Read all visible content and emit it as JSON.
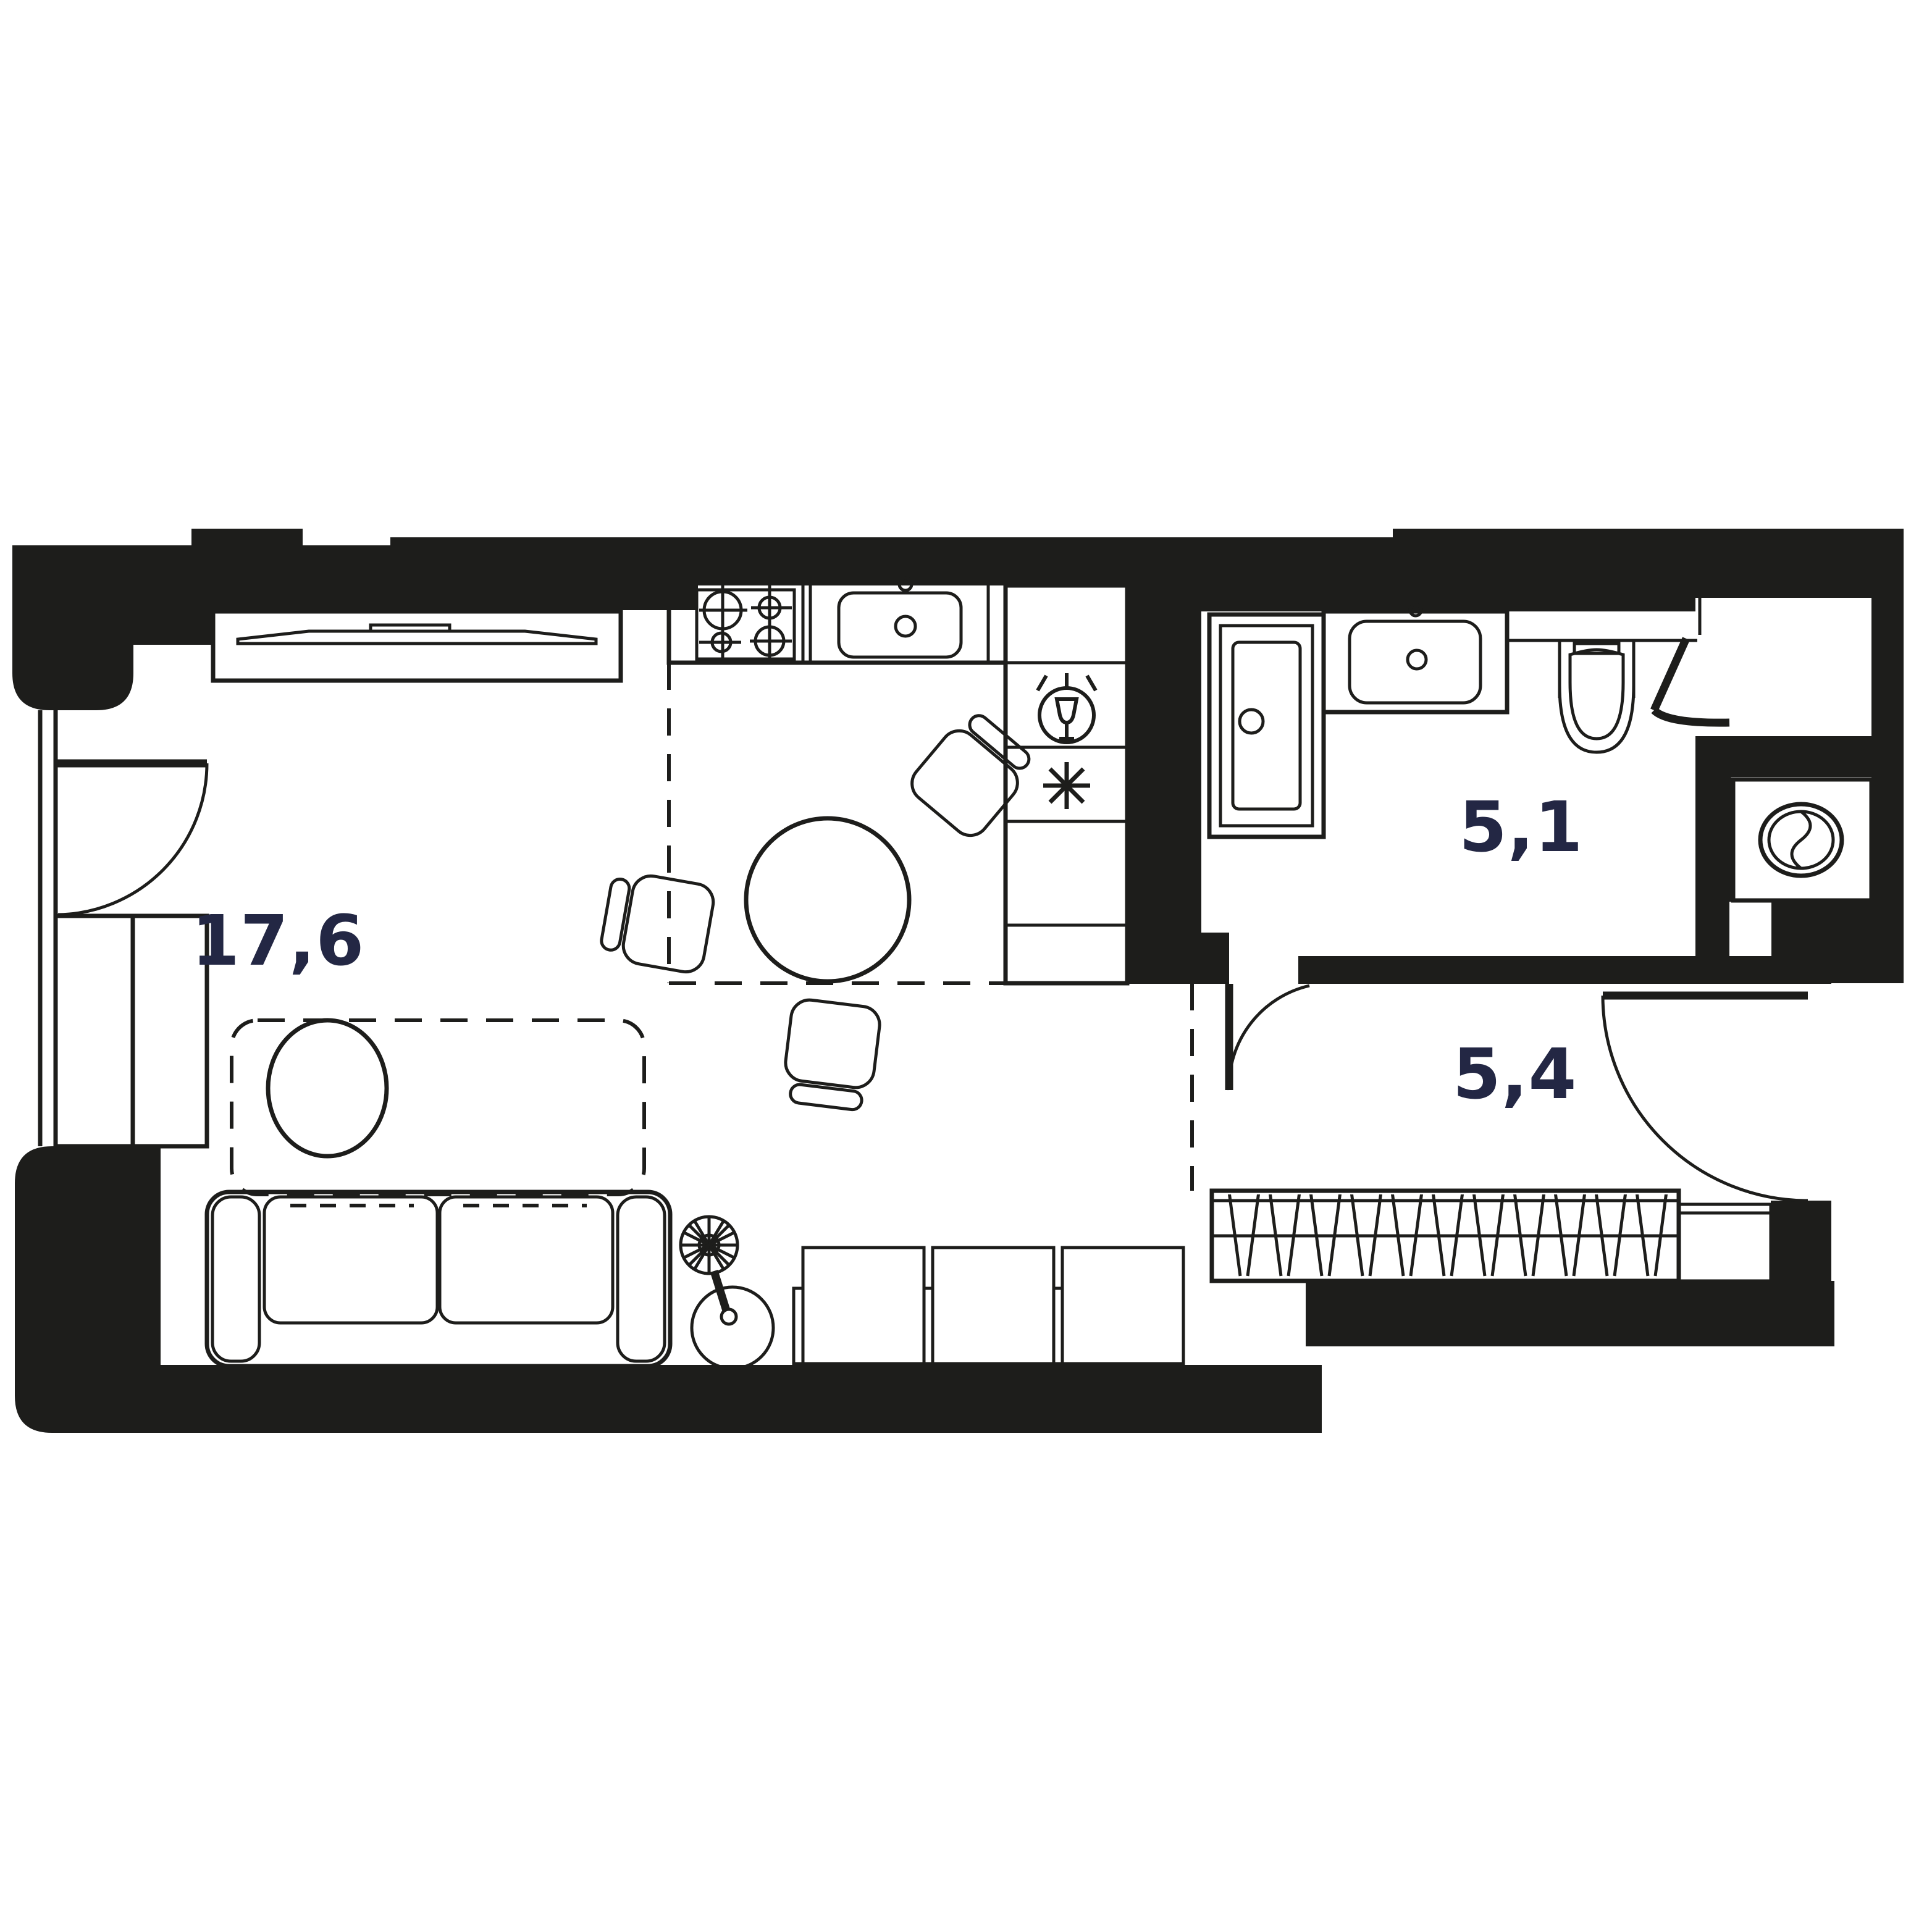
{
  "plan": {
    "type": "apartment-floor-plan",
    "background_color": "#ffffff",
    "wall_color": "#1d1d1b",
    "line_color": "#1d1d1b",
    "label_color": "#232744",
    "rooms": [
      {
        "id": "living-kitchen",
        "label": "17,6"
      },
      {
        "id": "bathroom",
        "label": "5,1"
      },
      {
        "id": "hallway",
        "label": "5,4"
      }
    ],
    "fixtures": [
      "tv-console",
      "kitchen-counter",
      "stove-4-burners",
      "kitchen-sink",
      "dishwasher",
      "fridge-freezer",
      "dining-table-round",
      "dining-chairs-3",
      "sofa-2-seat",
      "pouf",
      "rug-zone-dashed",
      "floor-lamp",
      "low-storage-cabinets-3",
      "bathtub",
      "vanity-sink",
      "wall-hung-toilet",
      "washing-machine",
      "wardrobe-hanging-rail",
      "hall-cabinet",
      "balcony-door",
      "bathroom-door",
      "entry-door",
      "closet-door",
      "window-left"
    ],
    "door_count": 4,
    "window_count": 1
  }
}
